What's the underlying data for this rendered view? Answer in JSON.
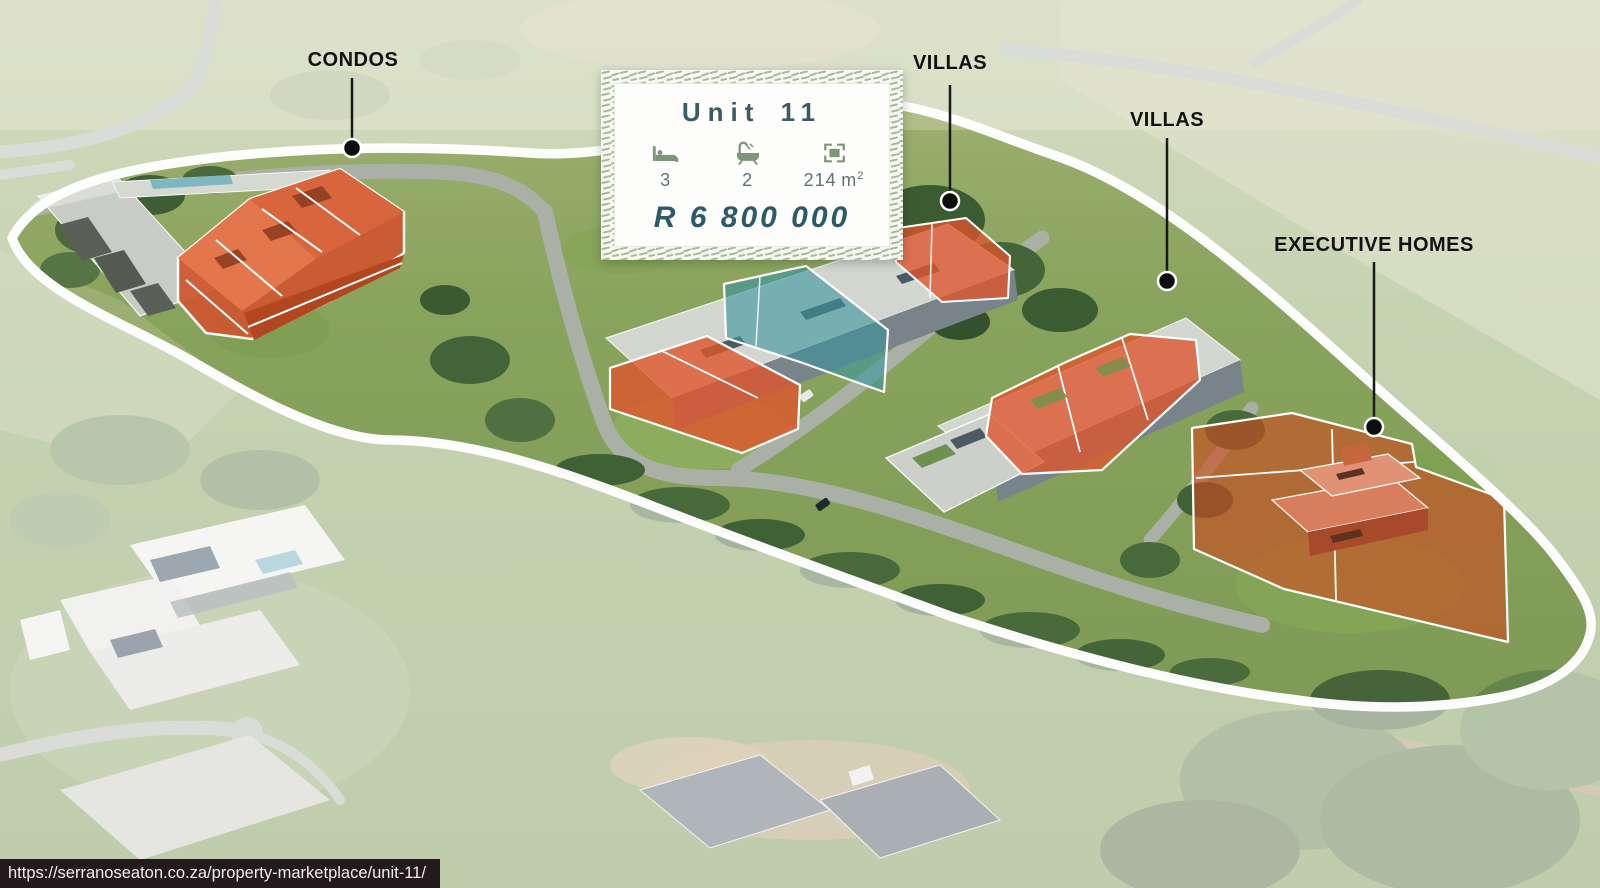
{
  "browser": {
    "status_url": "https://serranoseaton.co.za/property-marketplace/unit-11/"
  },
  "site_plan": {
    "category_labels": [
      {
        "id": "condos",
        "text": "CONDOS"
      },
      {
        "id": "villas-upper",
        "text": "VILLAS"
      },
      {
        "id": "villas-lower",
        "text": "VILLAS"
      },
      {
        "id": "executive-homes",
        "text": "EXECUTIVE HOMES"
      }
    ]
  },
  "unit_card": {
    "title": "Unit 11",
    "bedrooms": "3",
    "bathrooms": "2",
    "area_value": "214",
    "area_unit": "m",
    "area_sup": "2",
    "price": "R 6 800 000",
    "icons": [
      "bed-icon",
      "bath-icon",
      "floor-area-icon"
    ]
  },
  "colors": {
    "available_highlight": "#d95a2e",
    "selected_highlight": "#3f949c",
    "boundary_outline": "#ffffff",
    "card_accent_text": "#2c5a68",
    "card_icon_green": "#7e957a",
    "card_pattern_green": "#a7bb9b",
    "label_text": "#121212",
    "status_bar_bg": "#191015",
    "status_bar_text": "#f2eef0"
  }
}
